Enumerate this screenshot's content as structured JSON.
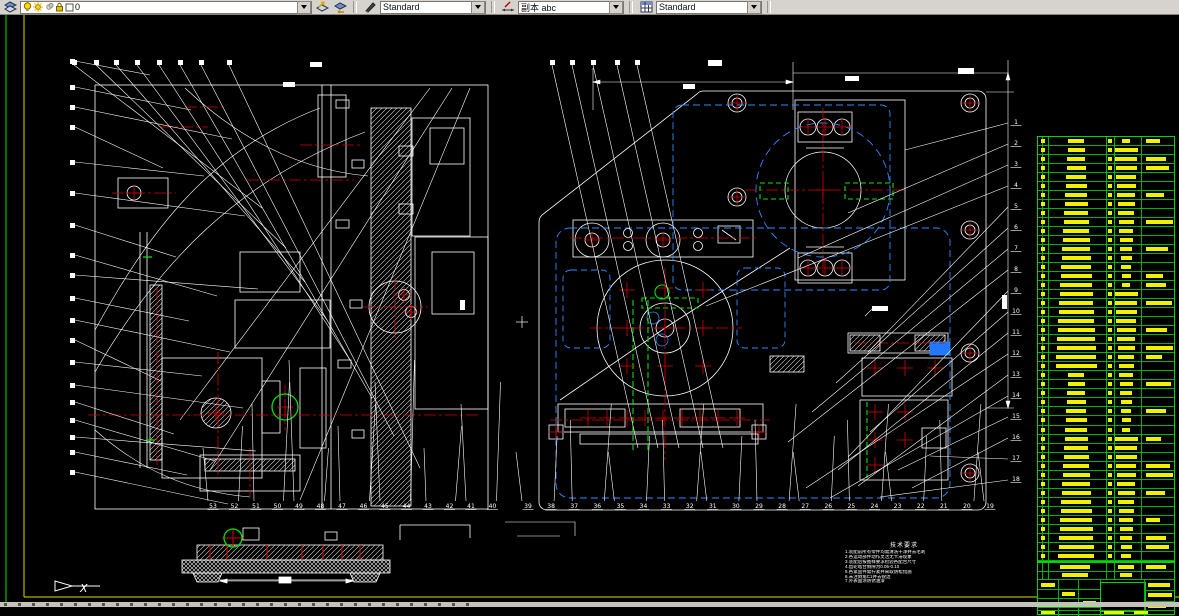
{
  "toolbar": {
    "layer_dropdown": {
      "current_layer": "0"
    },
    "text_style_dropdown": {
      "value": "Standard"
    },
    "dim_style_dropdown": {
      "value": "副本 abc"
    },
    "table_style_dropdown": {
      "value": "Standard"
    }
  },
  "ucs": {
    "axis_label": "X"
  },
  "balloons": {
    "right_edge": [
      "1",
      "2",
      "3",
      "4",
      "5",
      "6",
      "7",
      "8",
      "9",
      "10",
      "11",
      "12",
      "13",
      "14",
      "15",
      "16",
      "17",
      "18"
    ],
    "bottom_right": [
      "39",
      "38",
      "37",
      "36",
      "35",
      "34",
      "33",
      "32",
      "31",
      "30",
      "29",
      "28",
      "27",
      "26",
      "25",
      "24",
      "23",
      "22",
      "21",
      "20",
      "19"
    ],
    "bottom_left": [
      "53",
      "52",
      "51",
      "50",
      "49",
      "48",
      "47",
      "46",
      "45",
      "44",
      "43",
      "42",
      "41",
      "40"
    ]
  },
  "notes": {
    "title": "技术要求",
    "lines": [
      "1.装配前所有零件均需清洗干净并去毛刺",
      "2.各运动部件动作灵活无卡滞现象",
      "3.装配后按图样要求检验各配合尺寸",
      "4.齿轮啮合侧隙为0.05-0.10",
      "5.各紧固件需拧紧并采取防松措施",
      "6.未注倒角C1并去锐边",
      "7.外表面涂防锈油漆"
    ]
  },
  "parts_table": {
    "row_count": 47
  },
  "colors": {
    "canvas": "#000000",
    "line": "#ffffff",
    "centerline": "#d40000",
    "hidden_line": "#2e8bff",
    "highlight": "#00e000",
    "table_grid": "#00c400",
    "table_text": "#f0f000",
    "sheet_border_yellow": "#d8d800",
    "sheet_border_green": "#00a800"
  }
}
